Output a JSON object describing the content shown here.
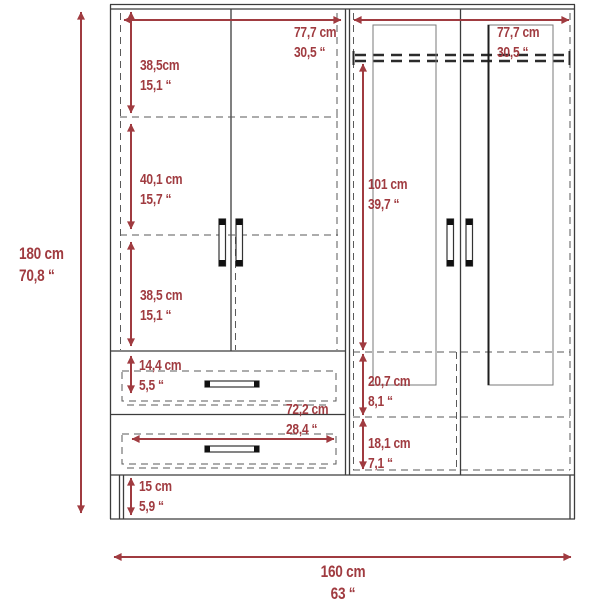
{
  "diagram": {
    "subject": "wardrobe-dimension-drawing",
    "colors": {
      "dimension_accent": "#a03b40",
      "structure_line": "#3c3c3c",
      "dashed_line": "#5a5a5a",
      "background": "#ffffff"
    }
  },
  "dimensions": {
    "overall_height": {
      "metric": "180 cm",
      "imperial": "70,8 “"
    },
    "overall_width": {
      "metric": "160 cm",
      "imperial": "63 “"
    },
    "left_section_width": {
      "metric": "77,7 cm",
      "imperial": "30,5 “"
    },
    "right_section_width": {
      "metric": "77,7 cm",
      "imperial": "30,5 “"
    },
    "upper_shelf_height": {
      "metric": "38,5cm",
      "imperial": "15,1 “"
    },
    "middle_shelf_height": {
      "metric": "40,1 cm",
      "imperial": "15,7 “"
    },
    "lower_shelf_height": {
      "metric": "38,5 cm",
      "imperial": "15,1 “"
    },
    "drawer_front_height": {
      "metric": "14,4 cm",
      "imperial": "5,5 “"
    },
    "drawer_width": {
      "metric": "72,2 cm",
      "imperial": "28,4 “"
    },
    "hanging_section_height": {
      "metric": "101 cm",
      "imperial": "39,7 “"
    },
    "right_upper_compartment_height": {
      "metric": "20,7 cm",
      "imperial": "8,1 “"
    },
    "right_lower_compartment_height": {
      "metric": "18,1 cm",
      "imperial": "7,1 “"
    },
    "base_height": {
      "metric": "15 cm",
      "imperial": "5,9 “"
    }
  }
}
